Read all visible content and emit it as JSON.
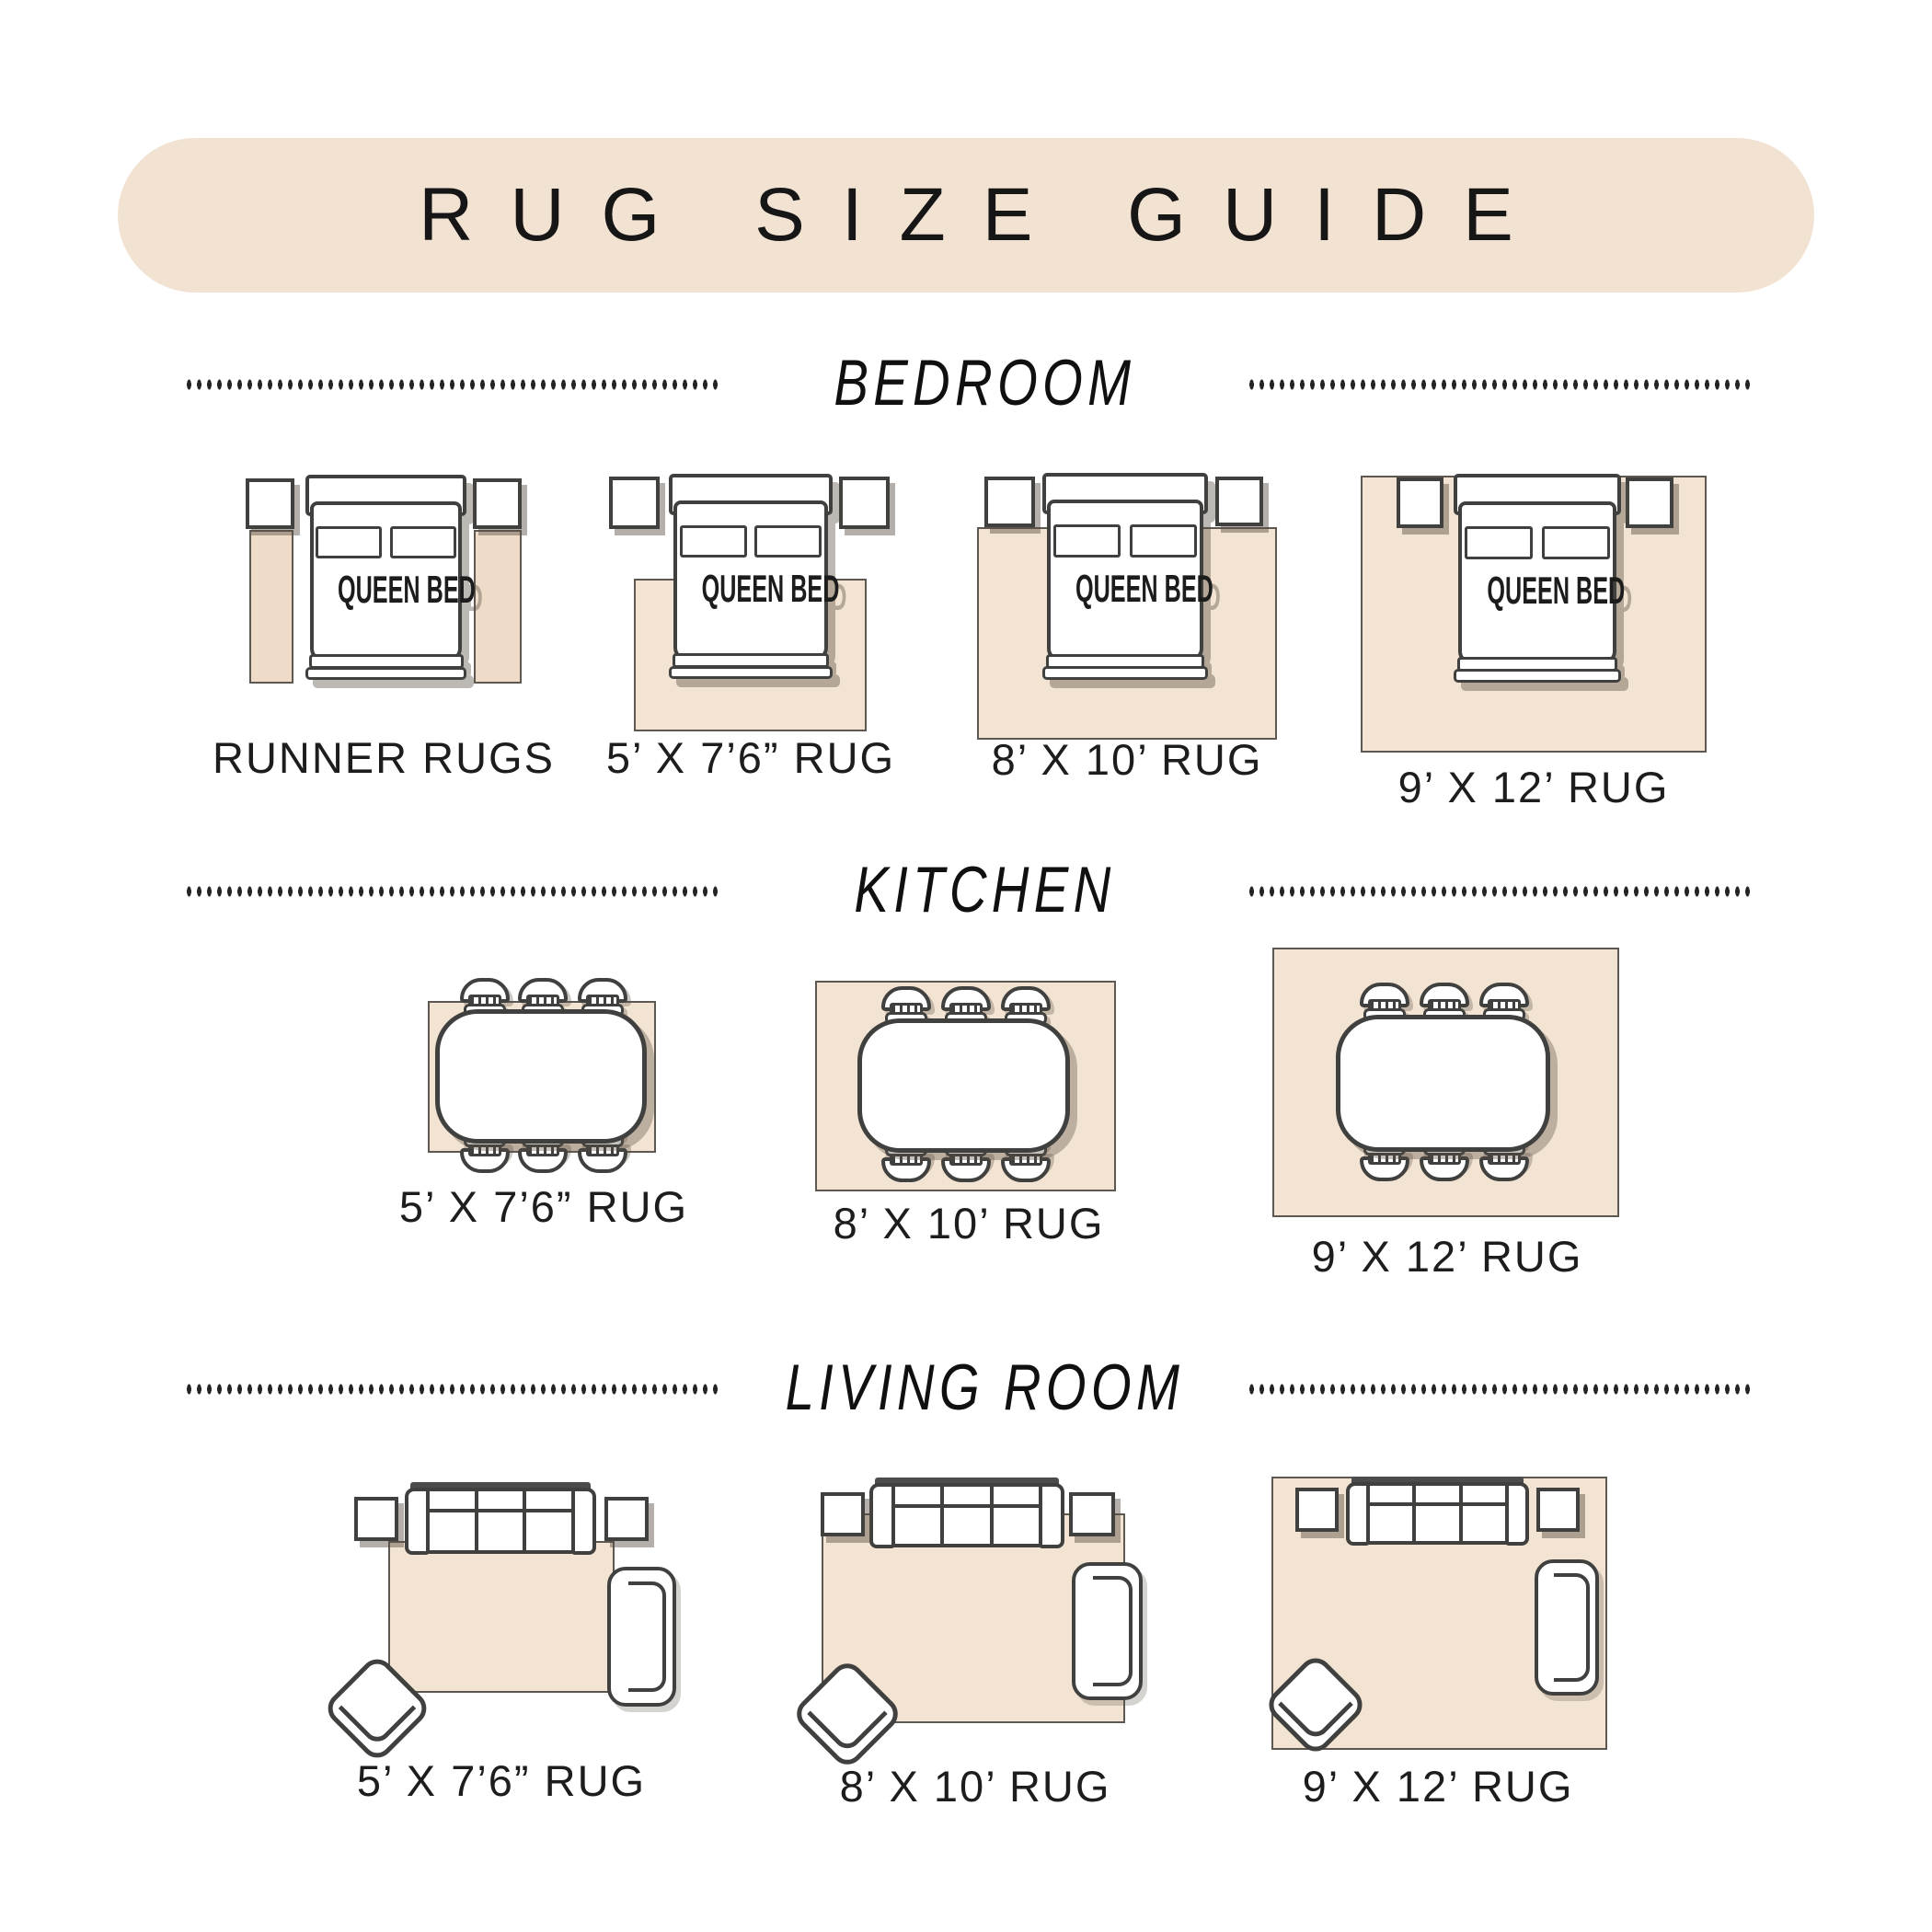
{
  "title": "RUG SIZE GUIDE",
  "bed_label": "QUEEN BED",
  "sections": {
    "bedroom": {
      "title": "BEDROOM",
      "labels": [
        "RUNNER RUGS",
        "5’ X 7’6” RUG",
        "8’ X 10’ RUG",
        "9’ X 12’ RUG"
      ]
    },
    "kitchen": {
      "title": "KITCHEN",
      "labels": [
        "5’ X 7’6” RUG",
        "8’ X 10’ RUG",
        "9’ X 12’ RUG"
      ]
    },
    "living_room": {
      "title": "LIVING ROOM",
      "labels": [
        "5’ X 7’6” RUG",
        "8’ X 10’ RUG",
        "9’ X 12’ RUG"
      ]
    }
  },
  "colors": {
    "banner_bg": "#F2E2D2",
    "rug_fill": "#F3E3D2",
    "runner_fill": "#EEDCC8",
    "outline": "#40413F",
    "text": "#1D1D1D",
    "shadow": "#9A9083"
  }
}
